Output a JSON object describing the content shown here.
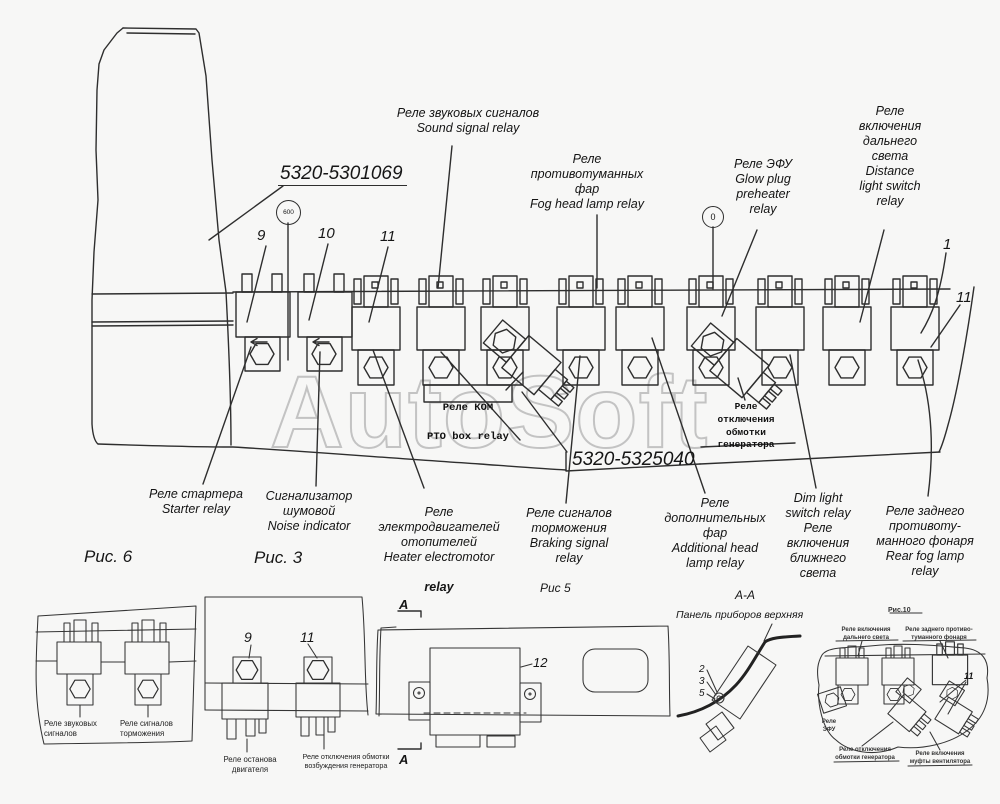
{
  "watermark": "AutoSoft",
  "part_numbers": {
    "upper": "5320-5301069",
    "lower": "5320-5325040"
  },
  "markers": {
    "m600": "600",
    "m0": "0"
  },
  "item_numbers": {
    "n9": "9",
    "n10": "10",
    "n11": "11",
    "n1": "1",
    "n11b": "11"
  },
  "top_labels": {
    "sound": "Реле звуковых сигналов\nSound signal relay",
    "fog": "Реле\nпротивотуманных\nфар\nFog head lamp relay",
    "efu": "Реле ЭФУ\nGlow plug\npreheater\nrelay",
    "distance": "Реле\nвключения\nдальнего\nсвета\nDistance\nlight switch\nrelay"
  },
  "bold_labels": {
    "kom_ru": "Реле КОМ",
    "kom_en": "PTO box relay",
    "gen_off": "Реле\nотключения\nобмотки\nгенератора"
  },
  "bottom_labels": {
    "starter": "Реле стартера\nStarter relay",
    "noise": "Сигнализатор\nшумовой\nNoise indicator",
    "heater": "Реле\nэлектродвигателей\nотопителей\nHeater electromotor",
    "heater_bold": "relay",
    "braking": "Реле сигналов\nторможения\nBraking signal\nrelay",
    "additional": "Реле\nдополнительных\nфар\nAdditional head\nlamp relay",
    "dim": "Dim light\nswitch relay\nРеле\nвключения\nближнего\nсвета",
    "rear_fog": "Реле заднего\nпротивоту-\nманного фонаря\nRear fog lamp\nrelay"
  },
  "figures": {
    "fig6": {
      "caption": "Рис. 6",
      "labels": [
        "Реле звуковых\nсигналов",
        "Реле сигналов\nторможения"
      ]
    },
    "fig3": {
      "caption": "Рис. 3",
      "numbers": [
        "9",
        "11"
      ],
      "labels": [
        "Реле останова\nдвигателя",
        "Реле отключения обмотки\nвозбуждения генератора"
      ]
    },
    "fig5": {
      "caption": "Рис 5"
    },
    "section": {
      "aa": "А-А",
      "arrow_top": "А",
      "arrow_bottom": "А",
      "item12": "12",
      "panel": "Панель приборов верхняя",
      "n2": "2",
      "n3": "3",
      "n5": "5"
    },
    "fig10": {
      "caption": "Рис.10",
      "n11": "11",
      "top_left": "Реле включения\nдальнего света",
      "top_right": "Реле заднего противо-\nтуманного фонаря",
      "left": "Реле\nЭФУ",
      "bottom_left": "Реле отключения\nобмотки генератора",
      "bottom_right": "Реле включения\nмуфты вентилятора"
    }
  }
}
